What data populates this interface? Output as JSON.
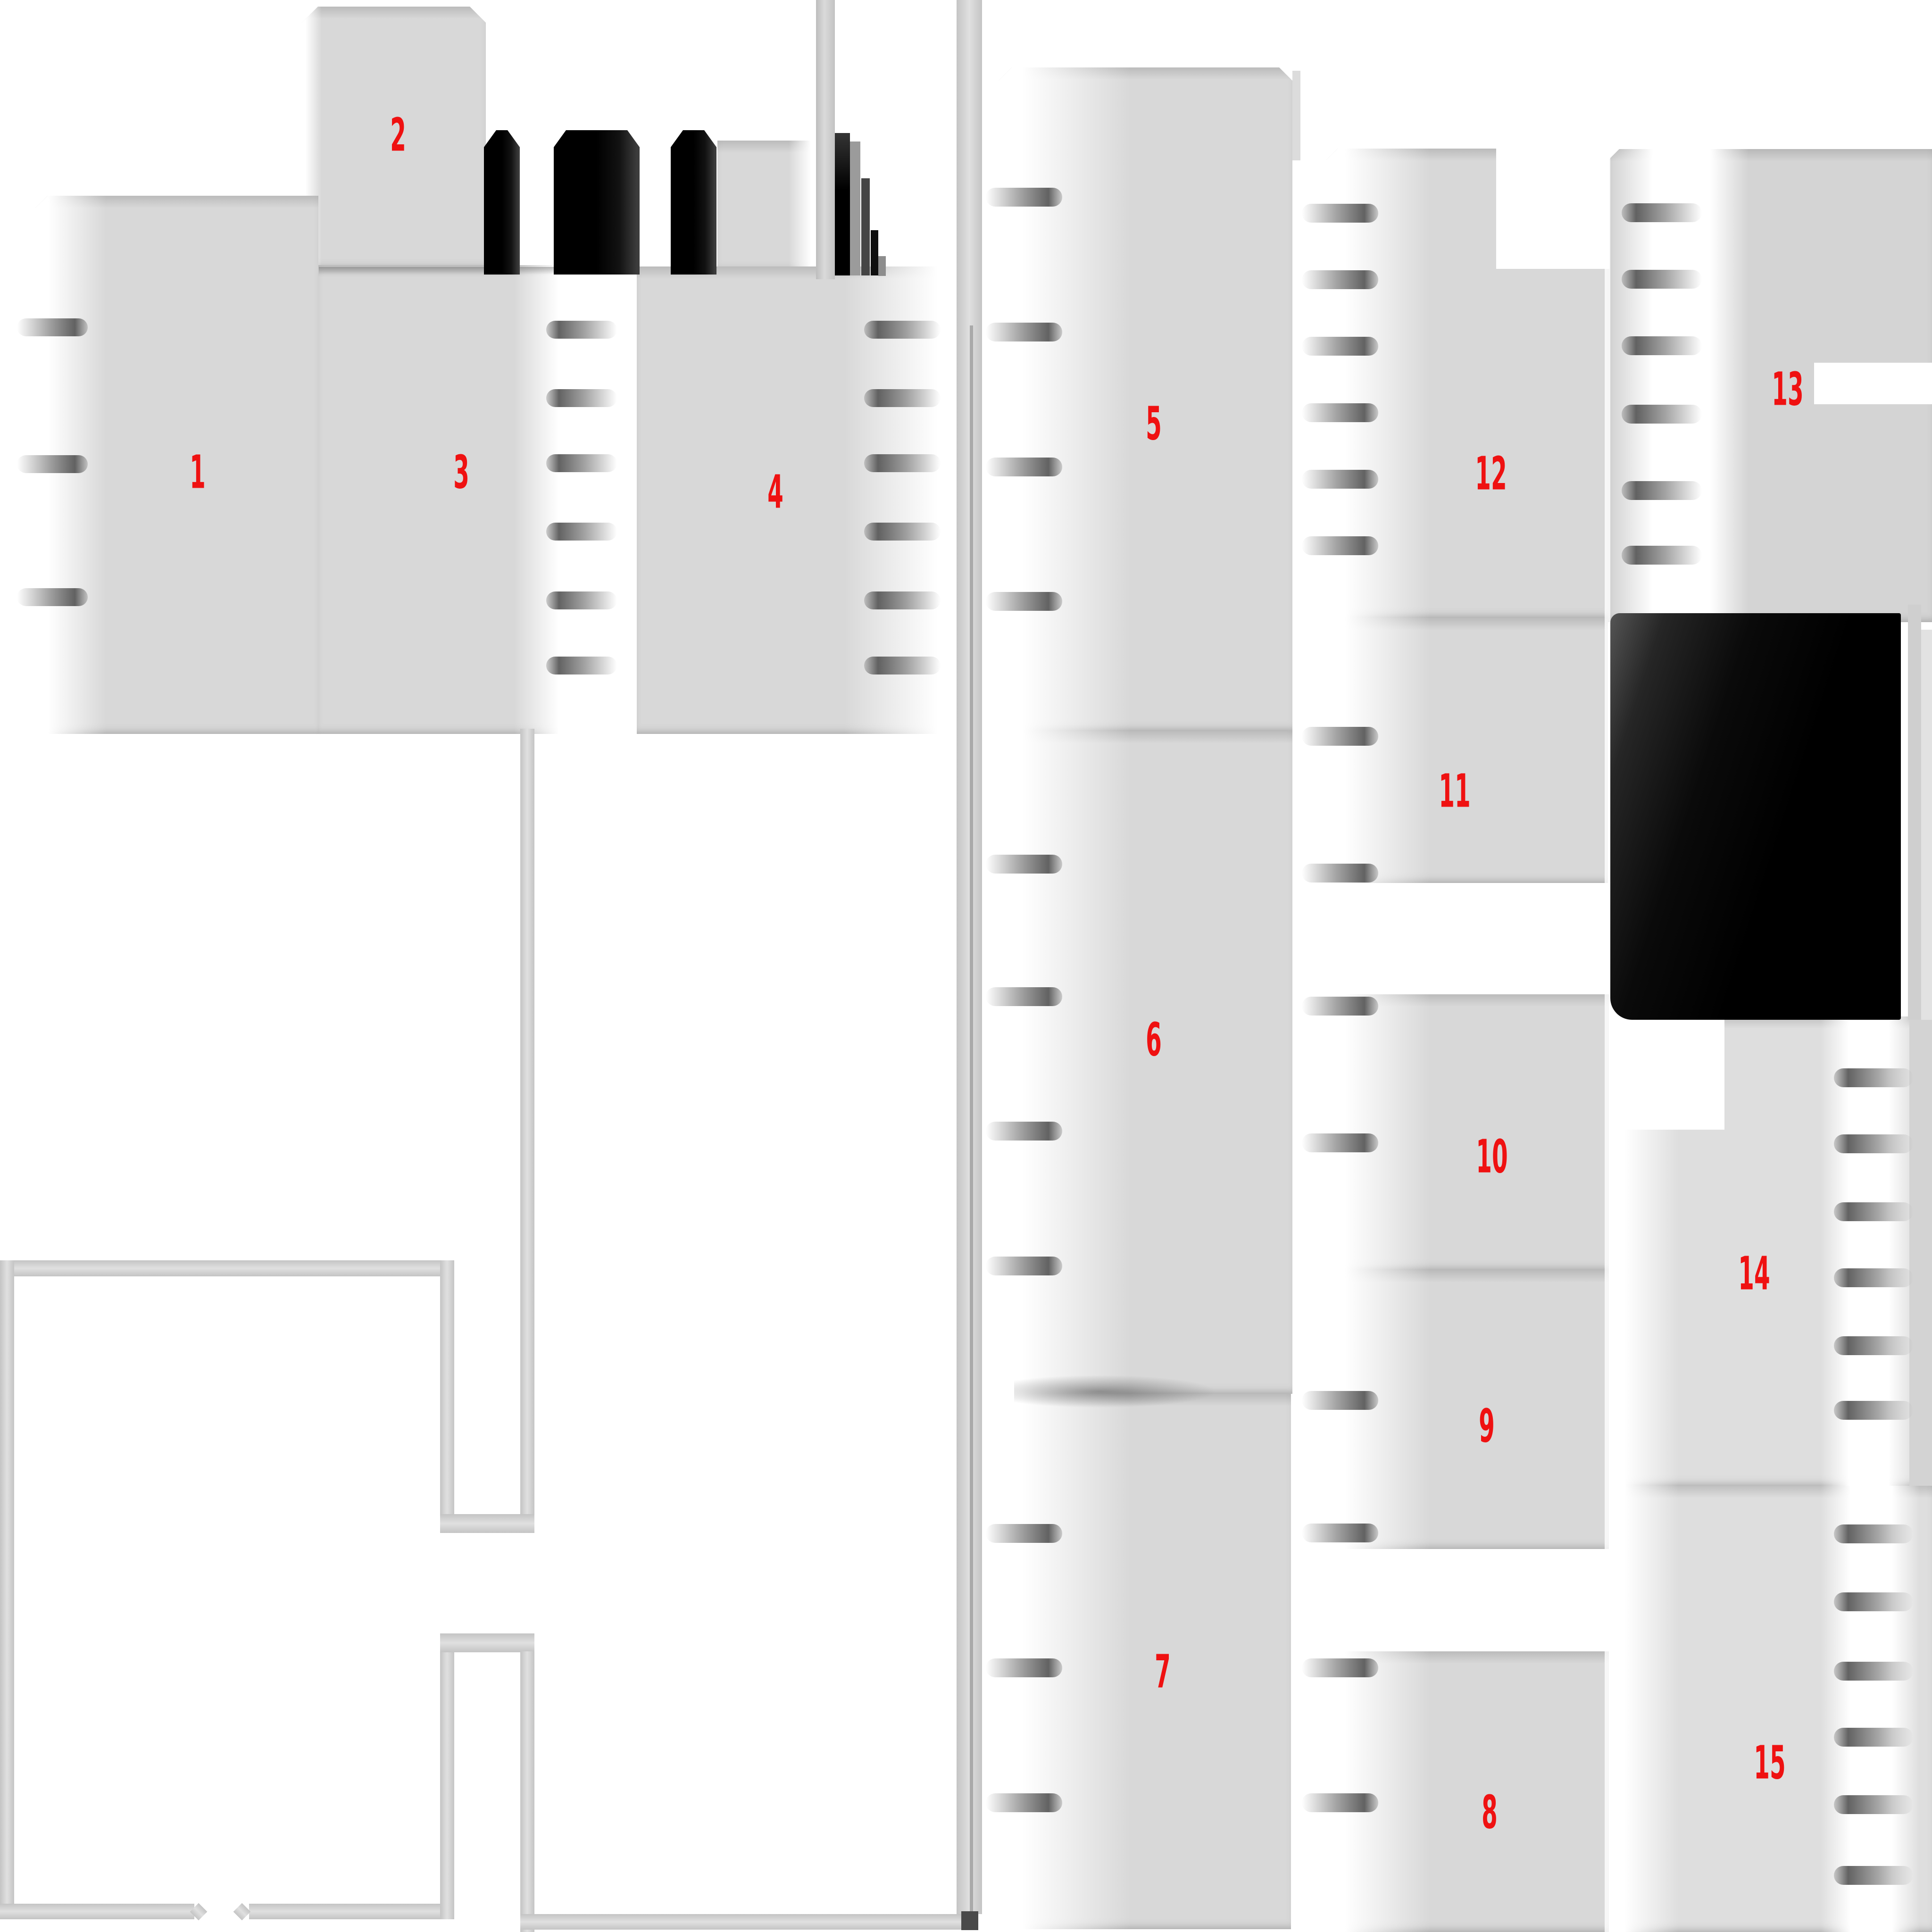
{
  "regions": [
    {
      "id": 1,
      "label": "1"
    },
    {
      "id": 2,
      "label": "2"
    },
    {
      "id": 3,
      "label": "3"
    },
    {
      "id": 4,
      "label": "4"
    },
    {
      "id": 5,
      "label": "5"
    },
    {
      "id": 6,
      "label": "6"
    },
    {
      "id": 7,
      "label": "7"
    },
    {
      "id": 8,
      "label": "8"
    },
    {
      "id": 9,
      "label": "9"
    },
    {
      "id": 10,
      "label": "10"
    },
    {
      "id": 11,
      "label": "11"
    },
    {
      "id": 12,
      "label": "12"
    },
    {
      "id": 13,
      "label": "13"
    },
    {
      "id": 14,
      "label": "14"
    },
    {
      "id": 15,
      "label": "15"
    }
  ],
  "colors": {
    "background": "#ffffff",
    "label": "#ef1111",
    "block_gray": "#d8d8d8",
    "dark_block": "#060606",
    "tick_gray": "#7e7e7e",
    "wall_gray": "#cfcfcf"
  }
}
